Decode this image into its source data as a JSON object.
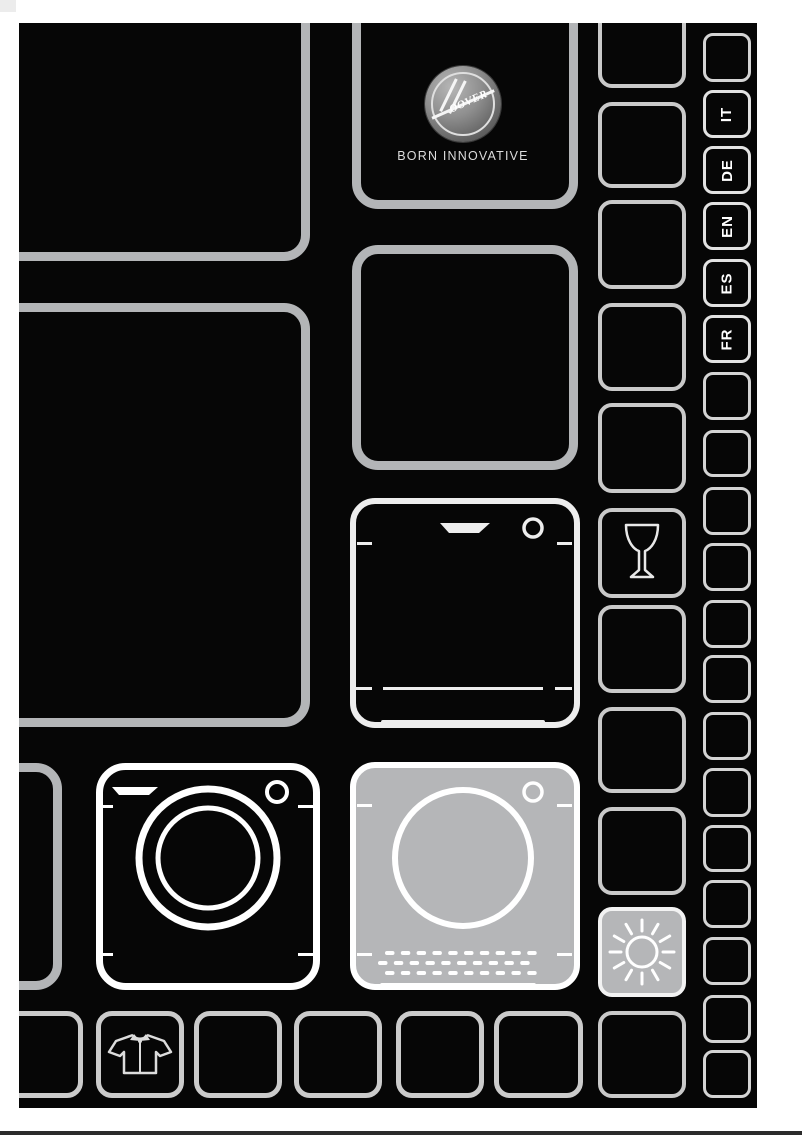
{
  "brand": {
    "name": "Hoover",
    "logo_text": "OOVER",
    "tagline": "BORN INNOVATIVE"
  },
  "languages": [
    {
      "code": "IT"
    },
    {
      "code": "DE"
    },
    {
      "code": "EN"
    },
    {
      "code": "ES"
    },
    {
      "code": "FR"
    }
  ],
  "icons": {
    "logo": "hoover-circle-logo",
    "glass": "wine-glass",
    "sun": "sun",
    "shirt": "shirt",
    "washer": "washing-machine",
    "dryer": "tumble-dryer",
    "dishwasher": "dishwasher"
  },
  "colors": {
    "page_bg": "#060606",
    "grid_border": "#b3b5b7",
    "highlight_fill": "#b5b6b8",
    "icon_stroke": "#ffffff",
    "label_text": "#ffffff",
    "margin_bg": "#ffffff"
  }
}
